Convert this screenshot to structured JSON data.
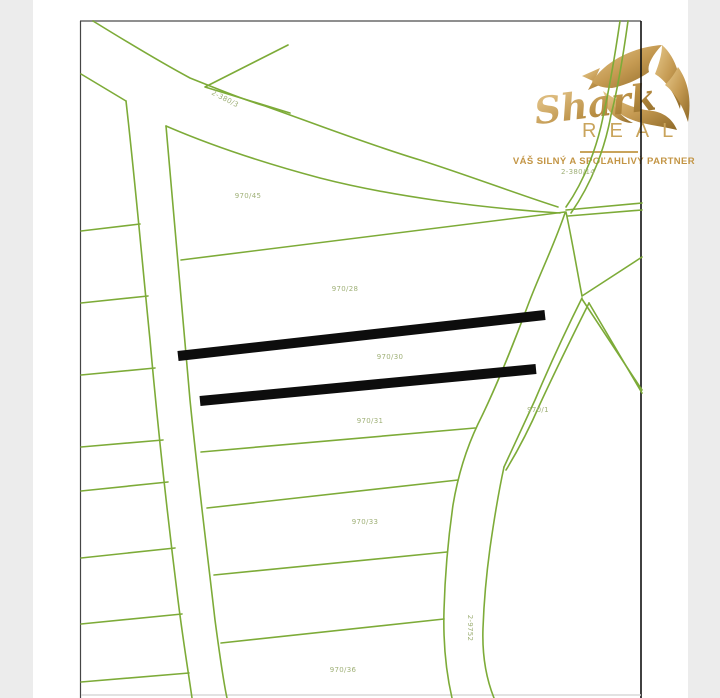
{
  "logo": {
    "script": "Shark",
    "wordmark": "REAL",
    "tagline": "VÁŠ SILNÝ A SPOĽAHLIVÝ PARTNER"
  },
  "map": {
    "labels": [
      {
        "text": "2-380/3"
      },
      {
        "text": "970/45"
      },
      {
        "text": "970/28"
      },
      {
        "text": "970/30"
      },
      {
        "text": "970/31"
      },
      {
        "text": "970/1"
      },
      {
        "text": "970/33"
      },
      {
        "text": "2-9752"
      },
      {
        "text": "970/36"
      },
      {
        "text": "2-380/14"
      }
    ],
    "colors": {
      "boundary_green": "#7dab38",
      "label_green": "#9fb077",
      "highlight_black": "#0d0d0d",
      "frame_gray": "#8f8f8f",
      "logo_gold": "#c9a45c",
      "side_strip_gray": "#ececec",
      "background": "#ffffff"
    }
  }
}
